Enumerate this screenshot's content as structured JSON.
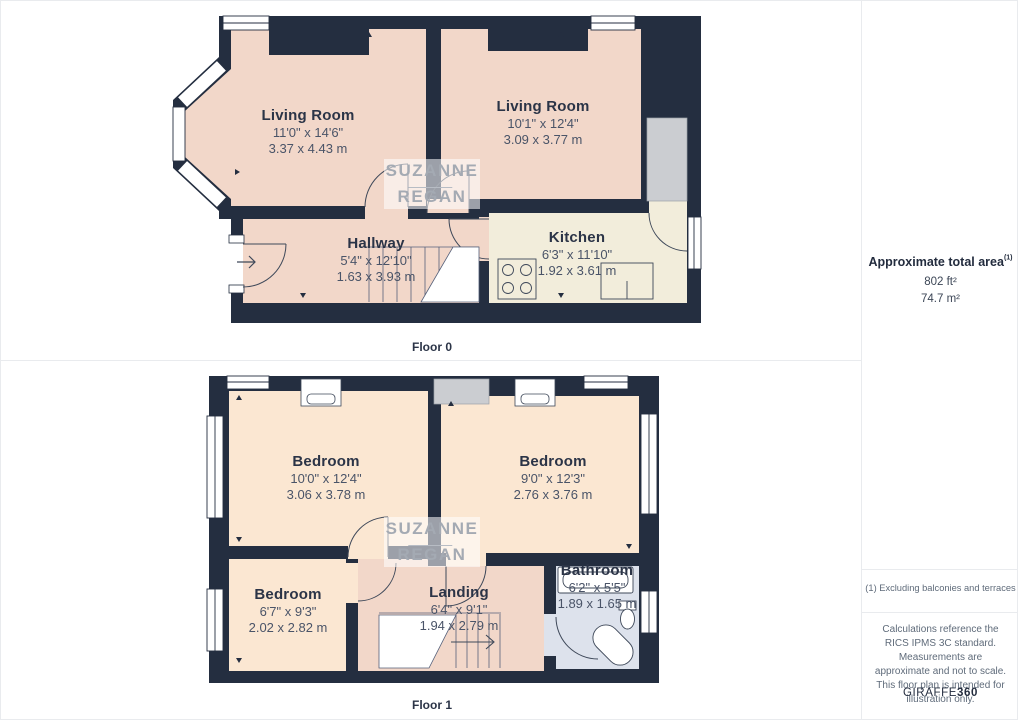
{
  "document": {
    "type": "floor-plan"
  },
  "floors": [
    {
      "label": "Floor 0",
      "rooms": [
        {
          "name": "Living Room",
          "imperial": "11'0\" x 14'6\"",
          "metric": "3.37 x 4.43 m"
        },
        {
          "name": "Living Room",
          "imperial": "10'1\" x 12'4\"",
          "metric": "3.09 x 3.77 m"
        },
        {
          "name": "Hallway",
          "imperial": "5'4\" x 12'10\"",
          "metric": "1.63 x 3.93 m"
        },
        {
          "name": "Kitchen",
          "imperial": "6'3\" x 11'10\"",
          "metric": "1.92 x 3.61 m"
        }
      ]
    },
    {
      "label": "Floor 1",
      "rooms": [
        {
          "name": "Bedroom",
          "imperial": "10'0\" x 12'4\"",
          "metric": "3.06 x 3.78 m"
        },
        {
          "name": "Bedroom",
          "imperial": "9'0\" x 12'3\"",
          "metric": "2.76 x 3.76 m"
        },
        {
          "name": "Bedroom",
          "imperial": "6'7\" x 9'3\"",
          "metric": "2.02 x 2.82 m"
        },
        {
          "name": "Landing",
          "imperial": "6'4\" x 9'1\"",
          "metric": "1.94 x 2.79 m"
        },
        {
          "name": "Bathroom",
          "imperial": "6'2\" x 5'5\"",
          "metric": "1.89 x 1.65 m"
        }
      ]
    }
  ],
  "watermark": {
    "line1": "SUZANNE",
    "line2": "REGAN"
  },
  "sidebar": {
    "area_title": "Approximate total area",
    "area_footnote_marker": "(1)",
    "area_imperial": "802 ft²",
    "area_metric": "74.7 m²",
    "footnote": "(1) Excluding balconies and terraces",
    "disclaimer": "Calculations reference the RICS IPMS 3C standard. Measurements are approximate and not to scale. This floor plan is intended for illustration only.",
    "brand_name": "GIRAFFE",
    "brand_suffix": "360"
  },
  "colors": {
    "wall": "#242e40",
    "living_hall": "#f2d7c9",
    "bedroom": "#fbe7d2",
    "kitchen": "#f2eddb",
    "bathroom": "#dde2ec",
    "storage": "#cbcdd1",
    "label_text": "#2b3447",
    "dim_text": "#4a5468",
    "watermark_text": "#a4aab3",
    "divider": "#e9ebee"
  }
}
